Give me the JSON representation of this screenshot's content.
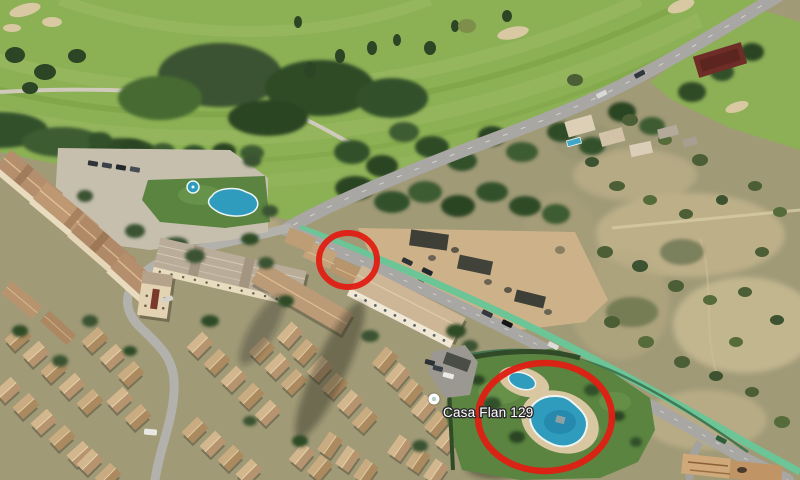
{
  "map_label": {
    "name": "Casa Flan 129"
  },
  "place_marker": {
    "type": "poi-dot"
  },
  "annotations": {
    "pool_circle": {
      "shape": "ellipse",
      "highlights": "swimming pool area"
    },
    "rooftop_circle": {
      "shape": "circle",
      "highlights": "apartment rooftop"
    }
  },
  "colors": {
    "annotation_red": "#e01d13",
    "pool_blue": "#2f9cbd",
    "pool_rim": "#ecf5f3",
    "golf_green": "#8cb054",
    "lawn_green": "#5a8440",
    "bike_path_green": "#6cc596",
    "scrub_tan": "#a09a77",
    "dirt_lot_tan": "#cdb289",
    "road_gray": "#a8a7a3",
    "street_gray": "#b3b1ac",
    "roof_terracotta": "#b58f6d",
    "tree_green": "#3a5230",
    "label_text": "#ffffff"
  }
}
